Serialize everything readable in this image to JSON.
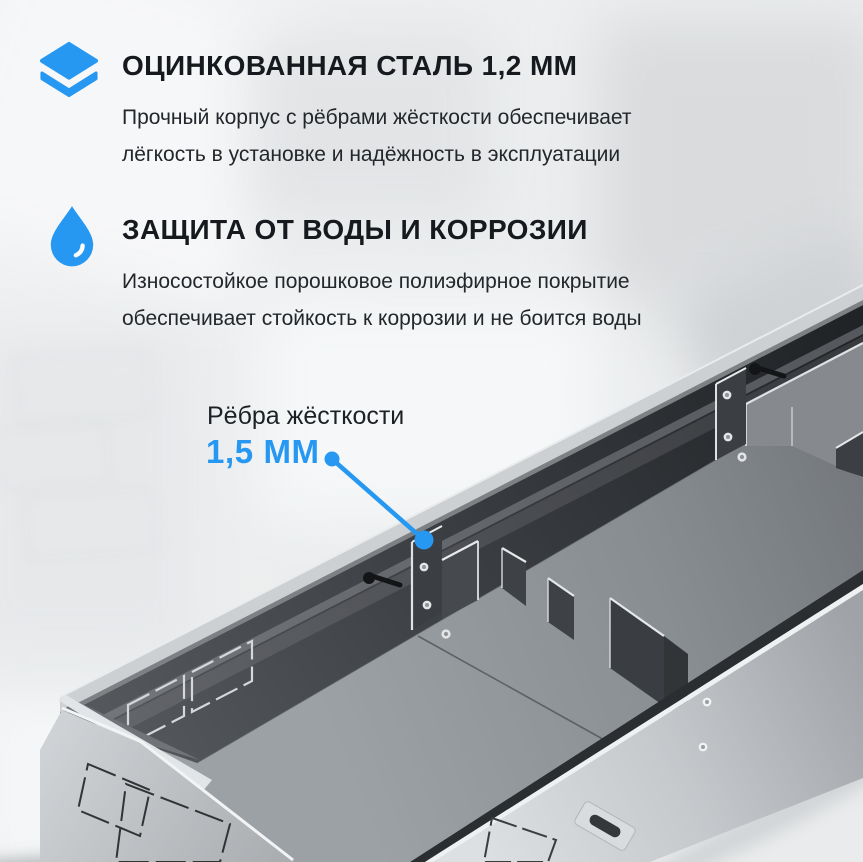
{
  "accent": "#2798F2",
  "features": [
    {
      "icon": "layers-icon",
      "title": "ОЦИНКОВАННАЯ СТАЛЬ 1,2 ММ",
      "desc_line1": "Прочный корпус с рёбрами жёсткости обеспечивает",
      "desc_line2": "лёгкость в установке и надёжность в эксплуатации"
    },
    {
      "icon": "drop-icon",
      "title": "ЗАЩИТА ОТ ВОДЫ И КОРРОЗИИ",
      "desc_line1": "Износостойкое порошковое полиэфирное покрытие",
      "desc_line2": "обеспечивает стойкость к коррозии и не боится воды"
    }
  ],
  "callout": {
    "label": "Рёбра жёсткости",
    "value": "1,5 ММ"
  }
}
